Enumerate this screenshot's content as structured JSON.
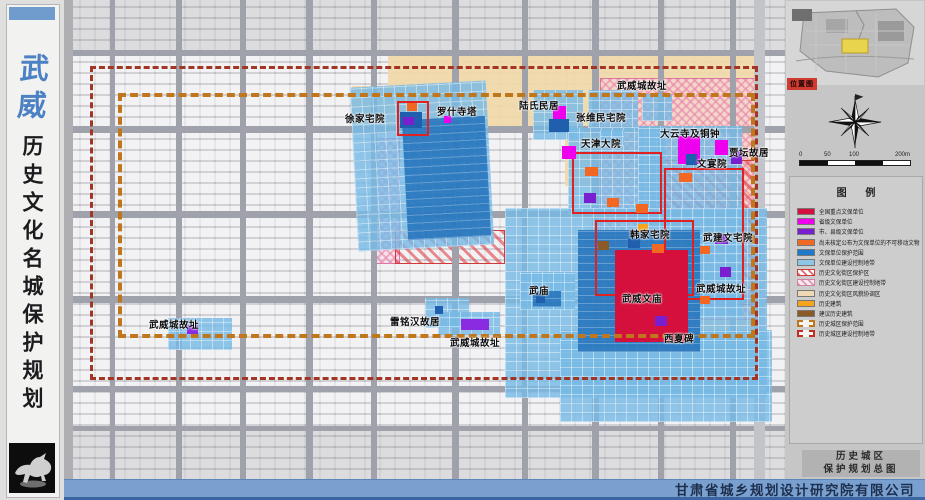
{
  "sidebar": {
    "city": "武威",
    "title": "历史文化名城保护规划",
    "logo": "bronze-galloping-horse"
  },
  "map": {
    "labels": [
      {
        "text": "徐家宅院"
      },
      {
        "text": "罗什寺塔"
      },
      {
        "text": "陆氏民居"
      },
      {
        "text": "武威城故址"
      },
      {
        "text": "张维民宅院"
      },
      {
        "text": "天津大院"
      },
      {
        "text": "大云寺及铜钟"
      },
      {
        "text": "贾坛故居"
      },
      {
        "text": "文宴院"
      },
      {
        "text": "韩家宅院"
      },
      {
        "text": "武建文宅院"
      },
      {
        "text": "武威城故址"
      },
      {
        "text": "武威文庙"
      },
      {
        "text": "武庙"
      },
      {
        "text": "雷铭汉故居"
      },
      {
        "text": "武威城故址"
      },
      {
        "text": "西夏碑"
      },
      {
        "text": "武威城故址"
      }
    ],
    "boundary_colors": {
      "historic_area_protection": "#c0761c",
      "construction_control": "#a23524"
    }
  },
  "right_panel": {
    "location_map_label": "位置图",
    "scale_ticks": [
      "0",
      "50",
      "100",
      "200m"
    ],
    "legend_title": "图  例",
    "legend": [
      {
        "label": "全国重点文保单位",
        "color": "#d5103f",
        "style": "solid"
      },
      {
        "label": "省级文保单位",
        "color": "#ee00ee",
        "style": "solid"
      },
      {
        "label": "市、县级文保单位",
        "color": "#7a1fd0",
        "style": "solid"
      },
      {
        "label": "尚未核定公布为文保单位的不可移动文物",
        "color": "#f26822",
        "style": "solid"
      },
      {
        "label": "文保单位保护范围",
        "color": "#1f78c8",
        "style": "solid"
      },
      {
        "label": "文保单位建设控制地带",
        "color": "#8fc6e8",
        "style": "solid"
      },
      {
        "label": "历史文化街区保护区",
        "color": "#e1404a",
        "style": "red-hatch"
      },
      {
        "label": "历史文化街区建设控制地带",
        "color": "#e880a8",
        "style": "pink-hatch"
      },
      {
        "label": "历史文化街区风貌协调区",
        "color": "#efd9b4",
        "style": "solid"
      },
      {
        "label": "历史建筑",
        "color": "#f5a41e",
        "style": "solid"
      },
      {
        "label": "建议历史建筑",
        "color": "#8a5a28",
        "style": "solid"
      },
      {
        "label": "历史城区保护范围",
        "color": "#c0761c",
        "style": "orange-dash"
      },
      {
        "label": "历史城区建设控制地带",
        "color": "#c03022",
        "style": "red-dash"
      }
    ],
    "titleblock": {
      "line1": "历史城区",
      "line2": "保护规划总图"
    }
  },
  "footer": {
    "company": "甘肃省城乡规划设计研究院有限公司"
  }
}
